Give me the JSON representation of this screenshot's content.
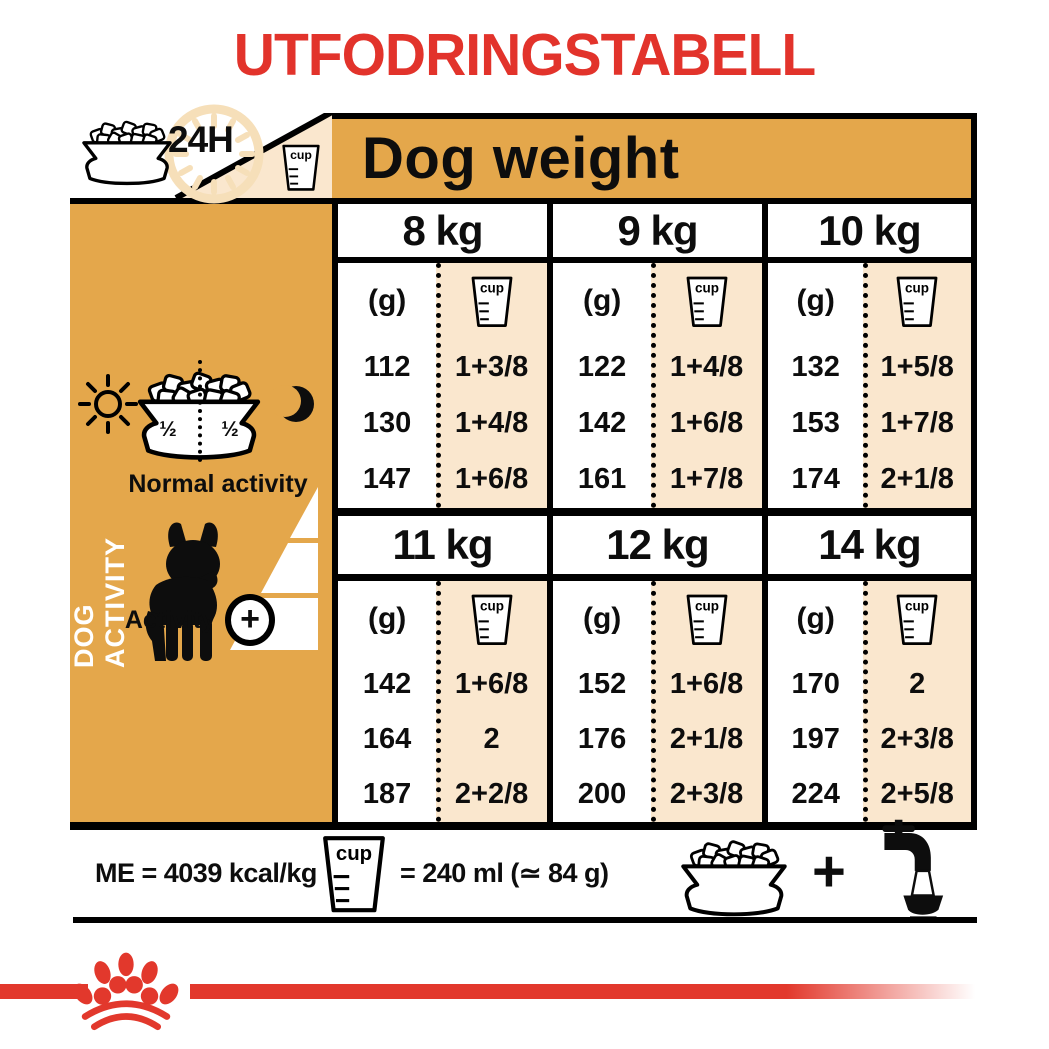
{
  "title": "UTFODRINGSTABELL",
  "labels": {
    "cup": "cup"
  },
  "header": {
    "hours_badge": "24H",
    "dog_weight": "Dog weight"
  },
  "sidebar": {
    "vertical_label": "DOG ACTIVITY",
    "bowl_half_left": "½",
    "bowl_half_right": "½",
    "normal_activity": "Normal activity",
    "activity": "Activity",
    "activity_plus": "+"
  },
  "table": {
    "grams_header": "(g)",
    "columns": [
      {
        "weight": "8 kg",
        "rows": [
          {
            "g": "112",
            "cups": "1+3/8"
          },
          {
            "g": "130",
            "cups": "1+4/8"
          },
          {
            "g": "147",
            "cups": "1+6/8"
          }
        ]
      },
      {
        "weight": "9 kg",
        "rows": [
          {
            "g": "122",
            "cups": "1+4/8"
          },
          {
            "g": "142",
            "cups": "1+6/8"
          },
          {
            "g": "161",
            "cups": "1+7/8"
          }
        ]
      },
      {
        "weight": "10 kg",
        "rows": [
          {
            "g": "132",
            "cups": "1+5/8"
          },
          {
            "g": "153",
            "cups": "1+7/8"
          },
          {
            "g": "174",
            "cups": "2+1/8"
          }
        ]
      },
      {
        "weight": "11 kg",
        "rows": [
          {
            "g": "142",
            "cups": "1+6/8"
          },
          {
            "g": "164",
            "cups": "2"
          },
          {
            "g": "187",
            "cups": "2+2/8"
          }
        ]
      },
      {
        "weight": "12 kg",
        "rows": [
          {
            "g": "152",
            "cups": "1+6/8"
          },
          {
            "g": "176",
            "cups": "2+1/8"
          },
          {
            "g": "200",
            "cups": "2+3/8"
          }
        ]
      },
      {
        "weight": "14 kg",
        "rows": [
          {
            "g": "170",
            "cups": "2"
          },
          {
            "g": "197",
            "cups": "2+3/8"
          },
          {
            "g": "224",
            "cups": "2+5/8"
          }
        ]
      }
    ]
  },
  "footer": {
    "me_text": "ME = 4039 kcal/kg",
    "cup_equivalence": "= 240 ml (≃ 84 g)",
    "plus": "+"
  },
  "colors": {
    "red": "#E2332B",
    "gold": "#E4A74B",
    "cream": "#FAE7CE",
    "clock": "#F6DFB9"
  }
}
